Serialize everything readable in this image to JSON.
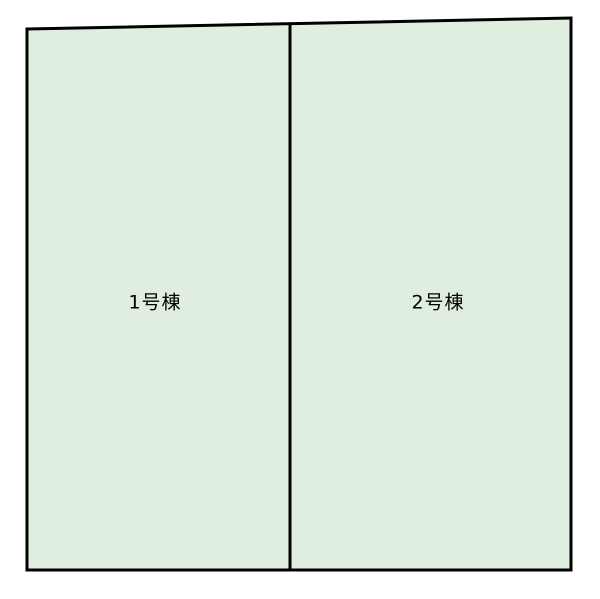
{
  "diagram": {
    "type": "site-plan",
    "background_color": "#ffffff",
    "parcel_fill_color": "#dfeede",
    "outline_color": "#000000",
    "text_color": "#000000",
    "parcels": [
      {
        "label": "1号棟"
      },
      {
        "label": "2号棟"
      }
    ]
  }
}
